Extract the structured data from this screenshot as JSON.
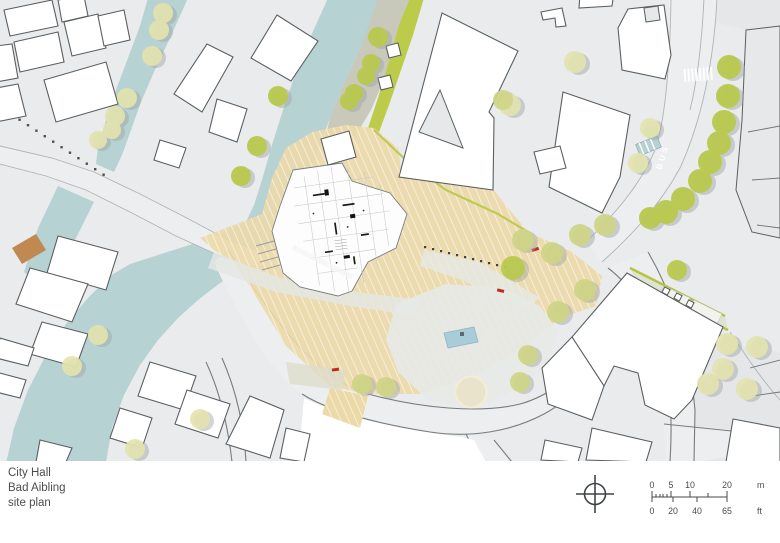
{
  "title_block": {
    "lines": [
      "City Hall",
      "Bad Aibling",
      "site plan"
    ]
  },
  "annotations": {
    "bus_label": "BUS"
  },
  "scale_bar": {
    "meters": {
      "ticks": [
        "0",
        "5",
        "10",
        "20"
      ],
      "unit": "m"
    },
    "feet": {
      "ticks": [
        "0",
        "20",
        "40",
        "65"
      ],
      "unit": "ft"
    }
  },
  "compass": {
    "type": "north-arrow"
  },
  "colors": {
    "water": "#b7d2d2",
    "tree_bright": "#b9c94e",
    "tree_mid": "#cfd586",
    "tree_pale": "#e3e3af",
    "tree_shadow": "#9fa4a4",
    "paving_tan": "#ecd9a8",
    "lawn_green": "#bdcb4a",
    "path_olive": "#c8c9ba",
    "building_fill": "#ffffff",
    "building_outline": "#5b5f61",
    "map_base": "#e9ebec",
    "bridge": "#c08952",
    "accent_red": "#c4291d",
    "pool": "#a9cdd8",
    "text": "#4d4d4d"
  }
}
